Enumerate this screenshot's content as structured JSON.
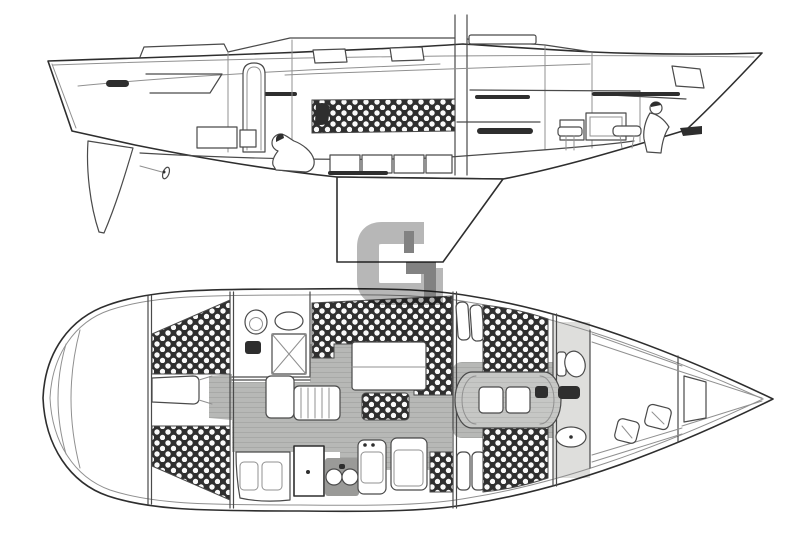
{
  "watermark": {
    "letter": "G"
  },
  "colors": {
    "background": "#ffffff",
    "ink": "#4a4a4a",
    "ink-strong": "#2e2e2e",
    "ink-light": "#909090",
    "floor": "#b7b8b6",
    "floor-grain": "#a8a9a7",
    "berth": "#c6c7c5",
    "berth-grain": "#b9bab8",
    "cushion": "#2f2f2f",
    "cushion-dot": "#fafafa",
    "shade": "#9a9a98",
    "wm-light": "#b7b7b7",
    "wm-dark": "#828282"
  }
}
